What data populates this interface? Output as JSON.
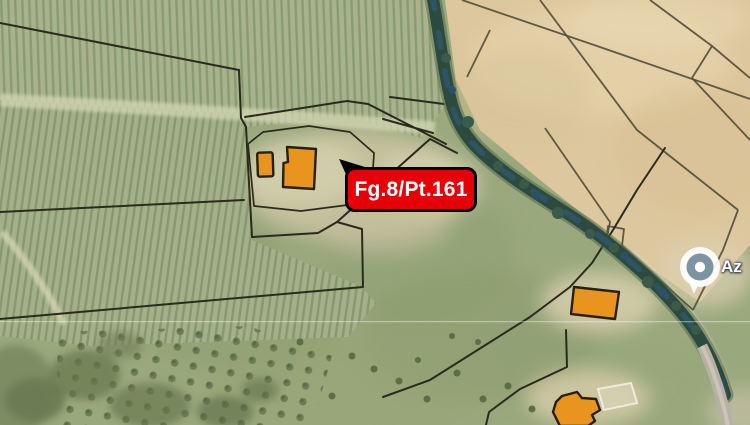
{
  "map": {
    "parcel_label": "Fg.8/Pt.161",
    "poi_label": "Az",
    "theme": {
      "label_bg": "#e60008",
      "label_text": "#ffffff",
      "label_border": "#000000",
      "building_fill": "#e8941f",
      "building_stroke": "#271f10",
      "boundary_dark": "#2b2a1e",
      "boundary_tan": "#554f3a",
      "pin_inner": "#7e93a2",
      "pin_outer": "#ffffff",
      "stream_green": "#2d4a3f",
      "stream_blue": "#2f566e"
    }
  }
}
